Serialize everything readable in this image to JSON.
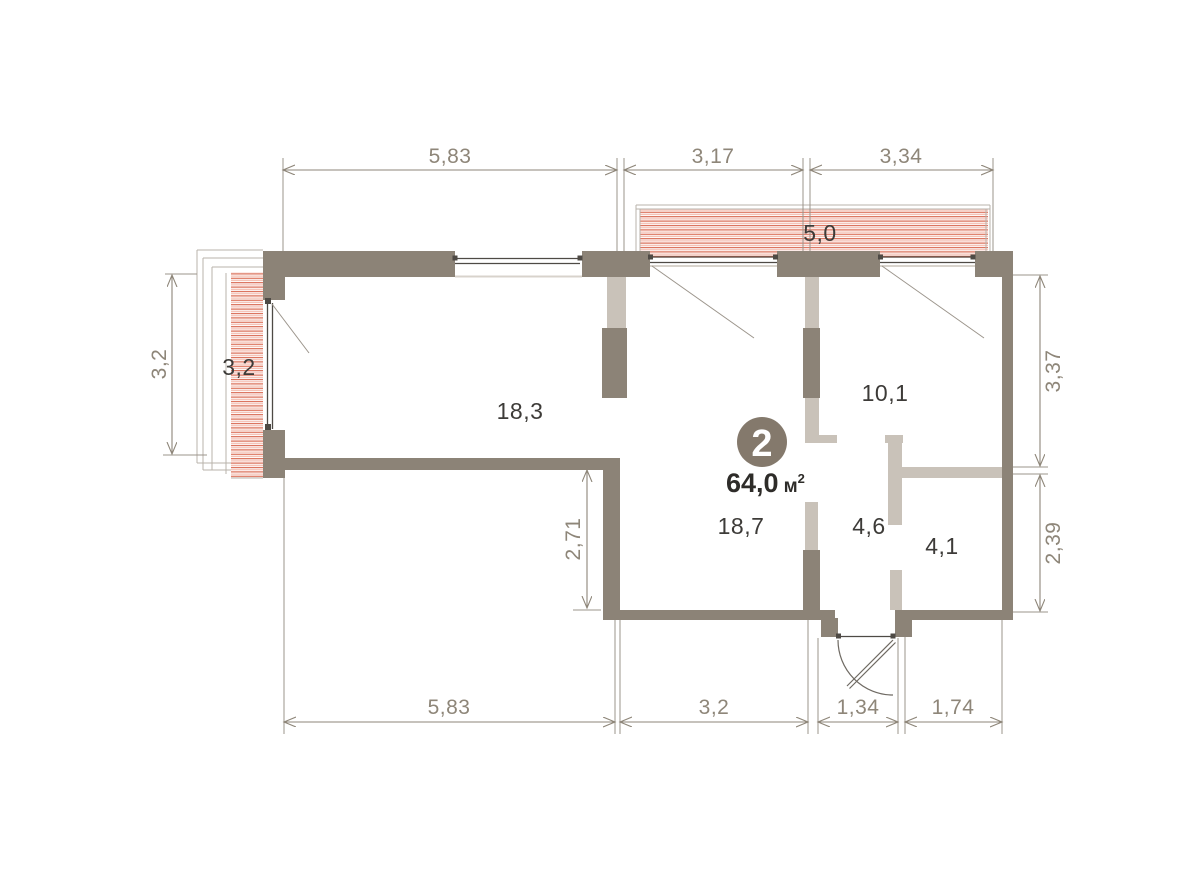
{
  "colors": {
    "bg": "#ffffff",
    "wall": "#8c8377",
    "partition": "#c9c2b9",
    "sill": "#d8d3cc",
    "frame": "#b9b3ab",
    "hatch_dark": "#d96a52",
    "hatch_light": "#f4bdb1",
    "dim": "#8e8679",
    "ext": "#9b948b",
    "window": "#4e4a45",
    "door": "#6f6a63",
    "room_label": "#3d3b38",
    "badge_bg": "#84796c",
    "badge_text": "#ffffff",
    "area_text": "#2e2c29"
  },
  "plan": {
    "badge_number": "2",
    "total_area": "64,0",
    "total_area_unit": "м",
    "total_area_sup": "2",
    "rooms": [
      {
        "name": "room-18-3",
        "area": "18,3"
      },
      {
        "name": "room-18-7",
        "area": "18,7"
      },
      {
        "name": "room-10-1",
        "area": "10,1"
      },
      {
        "name": "hall-4-6",
        "area": "4,6"
      },
      {
        "name": "bath-4-1",
        "area": "4,1"
      },
      {
        "name": "balcony-top-5-0",
        "area": "5,0"
      },
      {
        "name": "balcony-left-3-2",
        "area": "3,2"
      }
    ],
    "dims": {
      "top": [
        "5,83",
        "3,17",
        "3,34"
      ],
      "bottom": [
        "5,83",
        "3,2",
        "1,34",
        "1,74"
      ],
      "left": [
        "3,2"
      ],
      "right": [
        "3,37",
        "2,39"
      ],
      "interior": [
        "2,71"
      ]
    }
  }
}
